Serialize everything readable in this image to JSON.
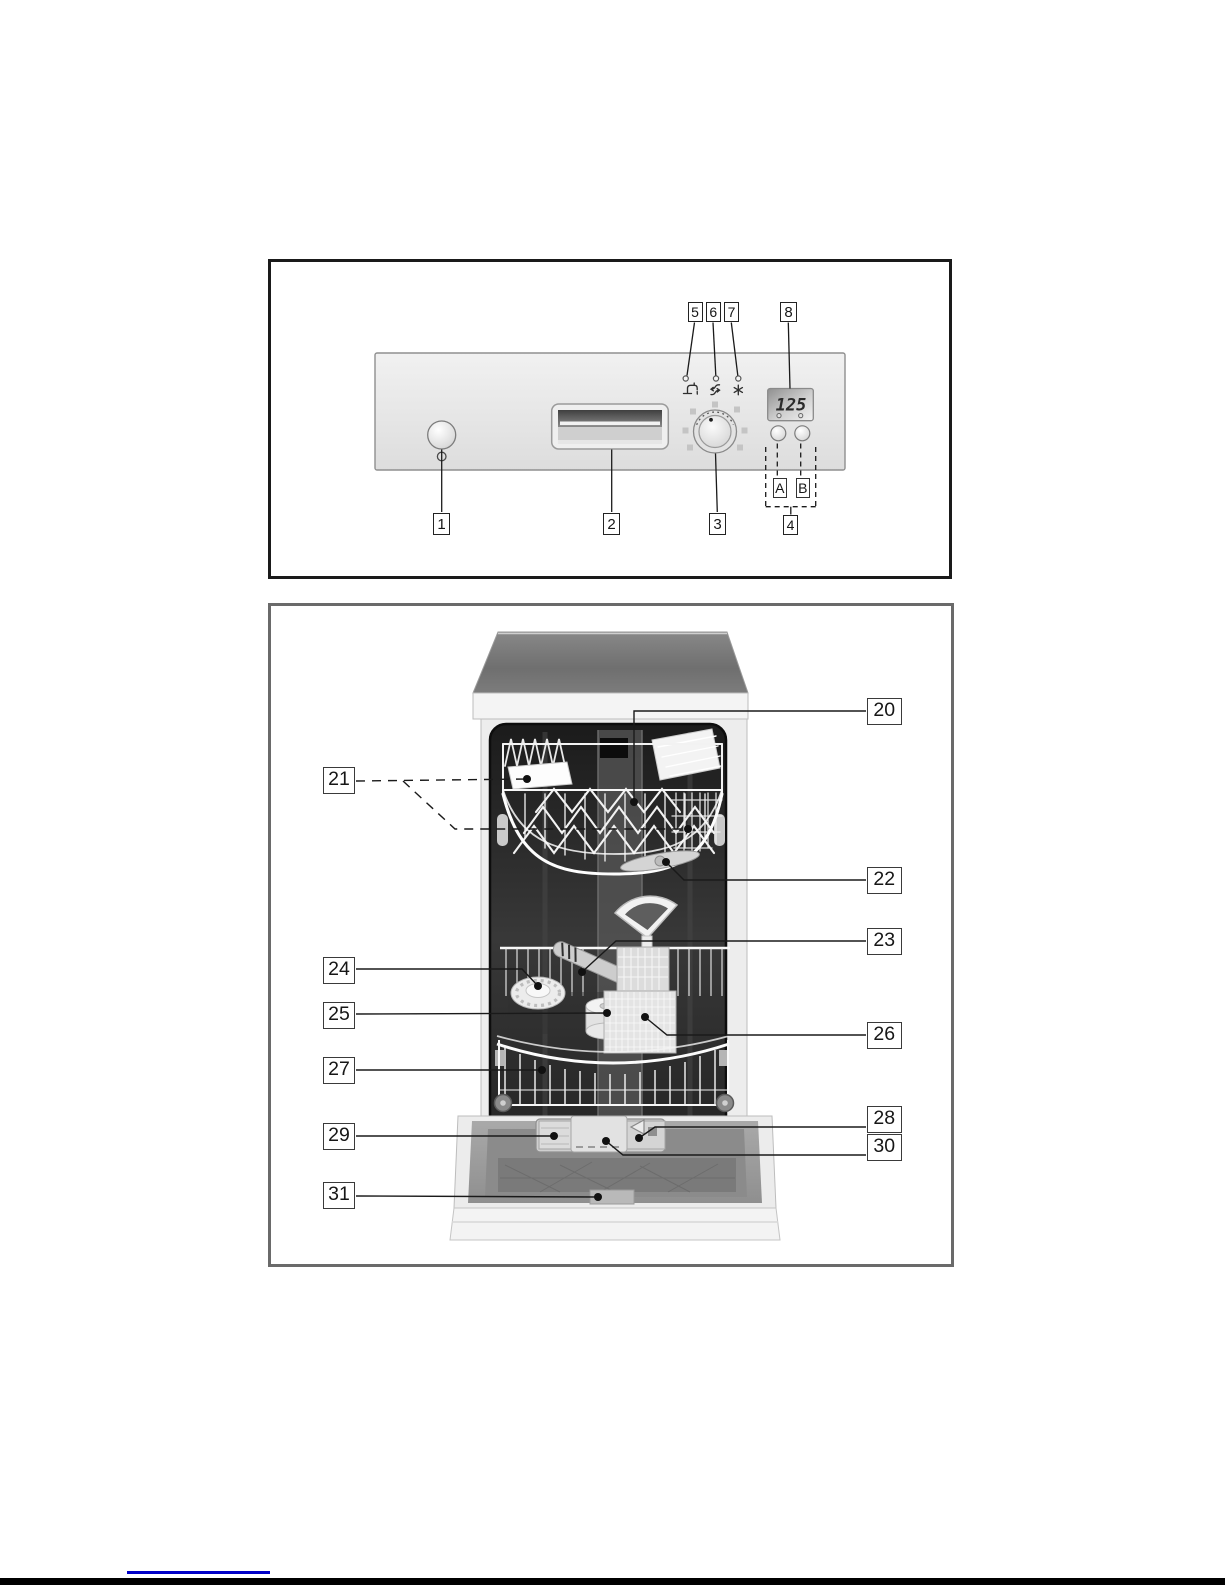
{
  "page": {
    "kind": "appliance manual illustration page",
    "figures": [
      "control panel diagram",
      "interior overview diagram"
    ]
  },
  "figure1": {
    "name": "dishwasher control panel",
    "display_value": "125",
    "callouts": {
      "1": "1",
      "2": "2",
      "3": "3",
      "4": "4",
      "5": "5",
      "6": "6",
      "7": "7",
      "8": "8",
      "A": "A",
      "B": "B"
    },
    "icons": [
      "power-icon",
      "water-tap-icon",
      "salt-refill-icon",
      "rinse-aid-icon"
    ],
    "colors": {
      "panel": "#ebebeb",
      "display_digits": "#2b2b2b"
    }
  },
  "figure2": {
    "name": "dishwasher interior with open door",
    "callouts": {
      "20": "20",
      "21": "21",
      "22": "22",
      "23": "23",
      "24": "24",
      "25": "25",
      "26": "26",
      "27": "27",
      "28": "28",
      "29": "29",
      "30": "30",
      "31": "31"
    }
  },
  "footer": {
    "link_underline_color": "#0000c8",
    "page_edge_color": "#000000"
  }
}
